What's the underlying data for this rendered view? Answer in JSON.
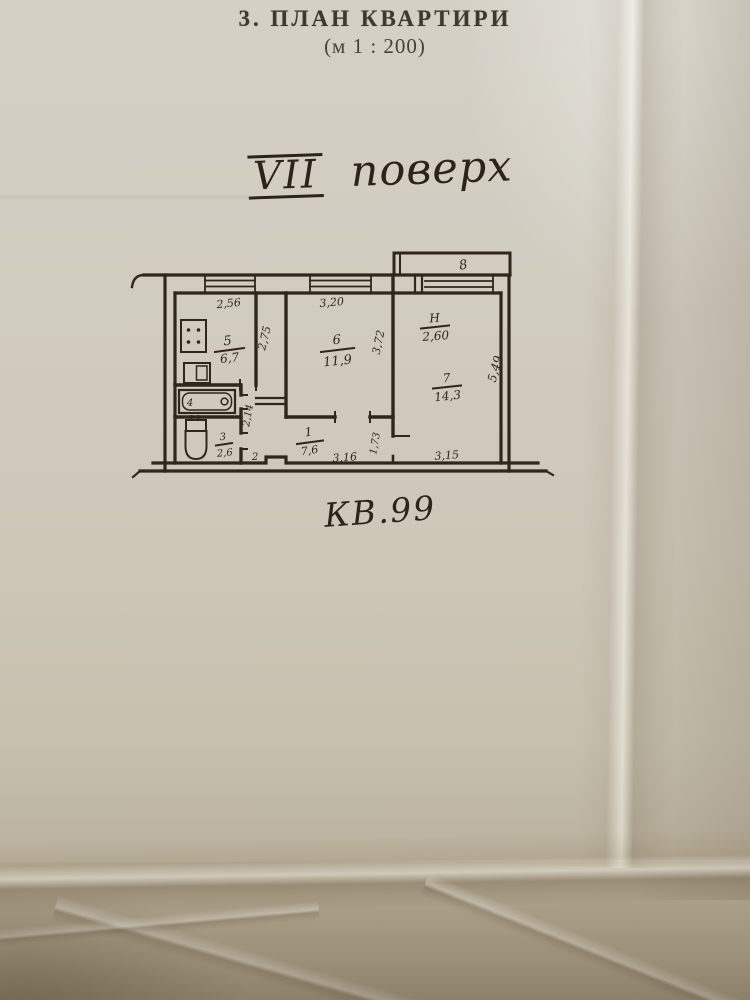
{
  "page": {
    "title": "3. ПЛАН КВАРТИРИ",
    "scale": "(м 1 : 200)",
    "floor": {
      "roman": "VII",
      "word": "поверх"
    },
    "apartment": "КВ.99"
  },
  "plan": {
    "ink": "#2f2719",
    "rooms": {
      "hall": {
        "num": "1",
        "area": "7,6"
      },
      "closet": {
        "num": "2"
      },
      "wc": {
        "num": "3",
        "area": "2,6"
      },
      "bath": {
        "num": "4"
      },
      "kitchen": {
        "num": "5",
        "area": "6,7"
      },
      "living": {
        "num": "6",
        "area": "11,9"
      },
      "bedroom": {
        "num": "7",
        "area": "14,3"
      },
      "balcony": {
        "num": "8"
      }
    },
    "height": {
      "label": "Н",
      "value": "2,60"
    },
    "dims": {
      "kitchen_w": "2,56",
      "kitchen_d": "2,75",
      "living_w": "3,20",
      "living_d": "3,72",
      "hall_w": "3,16",
      "hall_d": "1,73",
      "hall_l": "2,14",
      "bedroom_w": "3,15",
      "bedroom_d": "5,49"
    }
  }
}
